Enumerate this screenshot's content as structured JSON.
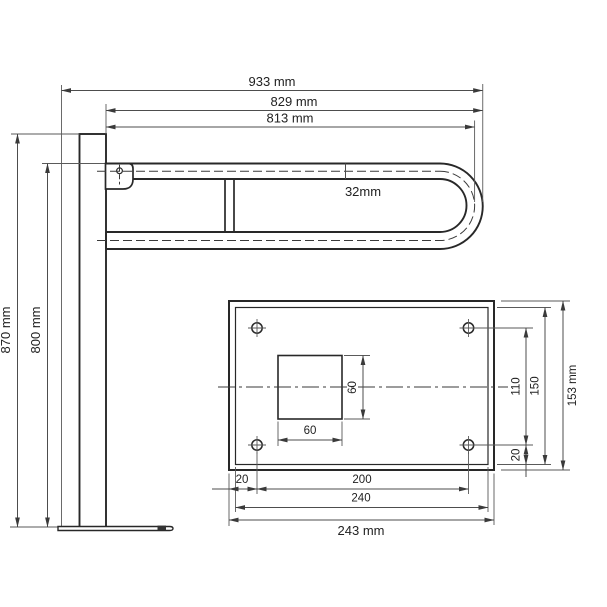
{
  "side_view": {
    "width_total": "933 mm",
    "width_outer": "829 mm",
    "width_center": "813 mm",
    "tube_diameter": "32mm",
    "height_post": "870 mm",
    "height_rail": "800 mm"
  },
  "plate_view": {
    "hole_offset_x": "20",
    "hole_spacing_x": "200",
    "inner_width": "240",
    "total_width": "243 mm",
    "square_width": "60",
    "square_height": "60",
    "hole_spacing_y": "110",
    "inner_height": "150",
    "total_height": "153 mm",
    "hole_offset_y": "20"
  },
  "colors": {
    "line": "#282828",
    "dimension": "#4d4d4d",
    "background": "#ffffff"
  }
}
